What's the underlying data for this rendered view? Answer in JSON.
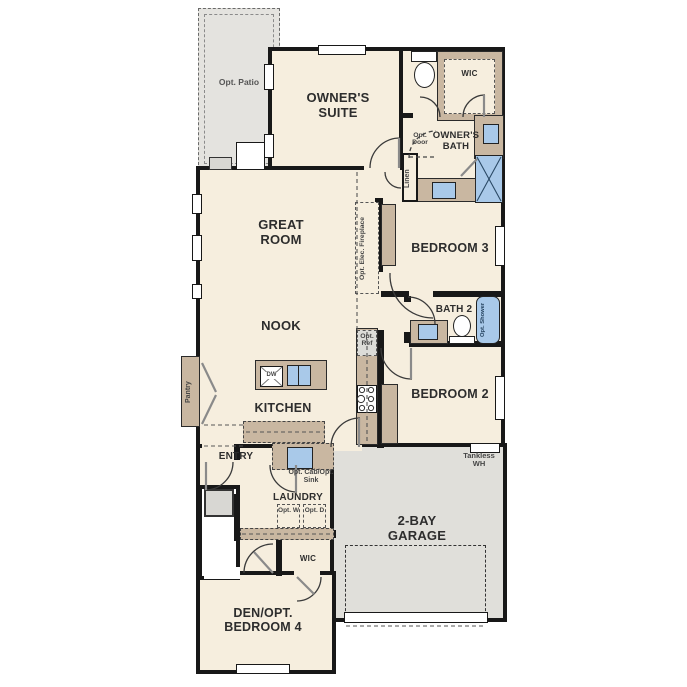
{
  "plan": {
    "rooms": {
      "opt_patio": "Opt. Patio",
      "owners_suite": "OWNER'S SUITE",
      "wic_top": "WIC",
      "owners_bath": "OWNER'S BATH",
      "great_room": "GREAT ROOM",
      "bedroom3": "BEDROOM 3",
      "bath2": "BATH 2",
      "nook": "NOOK",
      "kitchen": "KITCHEN",
      "bedroom2": "BEDROOM 2",
      "entry": "ENTRY",
      "laundry": "LAUNDRY",
      "wic_bottom": "WIC",
      "garage": "2-BAY GARAGE",
      "den": "DEN/OPT. BEDROOM 4"
    },
    "annotations": {
      "opt_door": "Opt. Door",
      "linen": "Linen",
      "fireplace": "Opt. Elec. Fireplace",
      "opt_shower": "Opt. Shower",
      "opt_ref": "Opt. Ref",
      "pantry": "Pantry",
      "opt_cab_sink": "Opt. Cab/Opt. Sink",
      "opt_w": "Opt. W",
      "opt_d": "Opt. D",
      "tankless": "Tankless WH",
      "dw": "DW"
    },
    "colors": {
      "floor": "#f6eede",
      "wall": "#181818",
      "cabinet_tan": "#c9b7a1",
      "garage_gray": "#e0dfda",
      "patio_gray": "#e4e3df",
      "fixture_blue": "#a9c9e9"
    }
  }
}
